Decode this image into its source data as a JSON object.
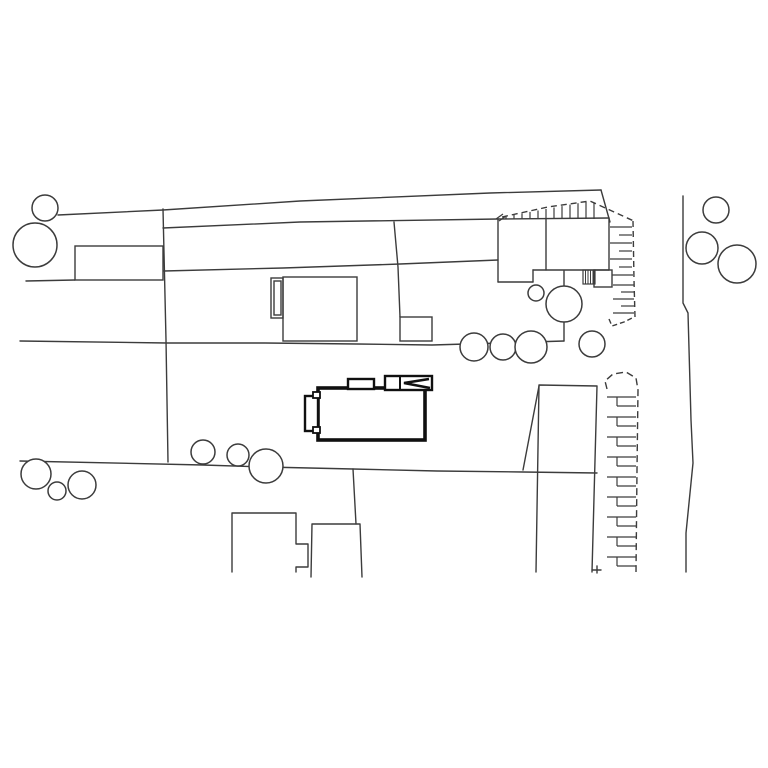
{
  "meta": {
    "canvas": {
      "w": 768,
      "h": 768
    },
    "colors": {
      "bg": "#ffffff",
      "line": "#3c3c3c",
      "bold": "#101010",
      "fill": "#ffffff"
    }
  },
  "plan": {
    "boundaries": {
      "width": 1.4,
      "polylines": [
        [
          [
            58,
            215
          ],
          [
            163,
            210
          ],
          [
            300,
            201
          ],
          [
            490,
            193
          ],
          [
            601,
            190
          ]
        ],
        [
          [
            601,
            190
          ],
          [
            610,
            222
          ]
        ],
        [
          [
            163,
            228
          ],
          [
            300,
            222
          ],
          [
            498,
            219
          ]
        ],
        [
          [
            26,
            281
          ],
          [
            75,
            280
          ]
        ],
        [
          [
            164,
            271
          ],
          [
            283,
            268
          ],
          [
            400,
            264
          ],
          [
            498,
            260
          ]
        ],
        [
          [
            20,
            341
          ],
          [
            167,
            343
          ],
          [
            265,
            343
          ],
          [
            357,
            344
          ],
          [
            432,
            345
          ],
          [
            500,
            343
          ],
          [
            564,
            341
          ]
        ],
        [
          [
            20,
            461
          ],
          [
            203,
            465
          ],
          [
            266,
            467
          ],
          [
            353,
            469
          ],
          [
            437,
            471
          ],
          [
            523,
            472
          ],
          [
            597,
            473
          ]
        ],
        [
          [
            163,
            209
          ],
          [
            166,
            340
          ],
          [
            168,
            462
          ]
        ],
        [
          [
            394,
            222
          ],
          [
            398,
            267
          ],
          [
            400,
            317
          ]
        ],
        [
          [
            353,
            469
          ],
          [
            356,
            524
          ]
        ],
        [
          [
            539,
            386
          ],
          [
            523,
            470
          ]
        ],
        [
          [
            564,
            271
          ],
          [
            564,
            341
          ]
        ],
        [
          [
            683,
            196
          ],
          [
            683,
            303
          ],
          [
            688,
            313
          ],
          [
            691,
            420
          ],
          [
            693,
            463
          ],
          [
            686,
            533
          ],
          [
            686,
            572
          ]
        ]
      ]
    },
    "buildings": {
      "width": 1.4,
      "rects": [
        [
          75,
          246,
          88,
          34
        ],
        [
          283,
          277,
          74,
          64
        ],
        [
          271,
          278,
          12,
          40
        ],
        [
          274,
          281,
          7,
          34
        ],
        [
          400,
          317,
          32,
          24
        ],
        [
          594,
          270,
          18,
          17
        ]
      ],
      "outlines": [
        [
          [
            232,
            572
          ],
          [
            232,
            513
          ],
          [
            296,
            513
          ],
          [
            296,
            544
          ],
          [
            308,
            544
          ],
          [
            308,
            567
          ],
          [
            296,
            567
          ],
          [
            296,
            572
          ]
        ],
        [
          [
            311,
            577
          ],
          [
            312,
            524
          ],
          [
            360,
            524
          ],
          [
            362,
            577
          ]
        ],
        [
          [
            536,
            572
          ],
          [
            539,
            385
          ],
          [
            597,
            386
          ],
          [
            592,
            572
          ]
        ],
        [
          [
            592,
            570
          ],
          [
            601,
            570
          ]
        ],
        [
          [
            597,
            566
          ],
          [
            597,
            573
          ]
        ],
        [
          [
            498,
            219
          ],
          [
            609,
            218
          ]
        ],
        [
          [
            498,
            219
          ],
          [
            498,
            282
          ]
        ],
        [
          [
            498,
            282
          ],
          [
            533,
            282
          ]
        ],
        [
          [
            533,
            282
          ],
          [
            533,
            270
          ]
        ],
        [
          [
            533,
            270
          ],
          [
            609,
            270
          ]
        ],
        [
          [
            609,
            218
          ],
          [
            609,
            270
          ]
        ],
        [
          [
            546,
            219
          ],
          [
            546,
            270
          ]
        ]
      ]
    },
    "dashed": {
      "width": 1.4,
      "polylines": [
        {
          "dash": "6 4",
          "pts": [
            [
              502,
              217
            ],
            [
              548,
              207
            ],
            [
              590,
              201
            ],
            [
              636,
              222
            ]
          ]
        },
        {
          "dash": "6 4",
          "pts": [
            [
              633,
              221
            ],
            [
              634,
              280
            ],
            [
              635,
              317
            ]
          ]
        },
        {
          "dash": "5 3",
          "pts": [
            [
              609,
              319
            ],
            [
              612,
              326
            ],
            [
              624,
              322
            ],
            [
              634,
              317
            ]
          ]
        },
        {
          "dash": "7 4",
          "pts": [
            [
              607,
              389
            ],
            [
              605,
              381
            ],
            [
              613,
              374
            ],
            [
              626,
              372
            ],
            [
              636,
              378
            ],
            [
              638,
              390
            ],
            [
              637,
              470
            ],
            [
              636,
              572
            ]
          ]
        }
      ]
    },
    "ticks": {
      "width": 1.2,
      "segments": [
        [
          506,
          216.3,
          506,
          219
        ],
        [
          514,
          214.9,
          514,
          219
        ],
        [
          522,
          213.4,
          522,
          219
        ],
        [
          530,
          211.9,
          530,
          219
        ],
        [
          538,
          210.5,
          538,
          219
        ],
        [
          546,
          209,
          546,
          219
        ],
        [
          554,
          207.5,
          554,
          219
        ],
        [
          562,
          206.1,
          562,
          219
        ],
        [
          570,
          204.6,
          570,
          219
        ],
        [
          578,
          203.2,
          578,
          219
        ],
        [
          586,
          201.7,
          586,
          219
        ],
        [
          594,
          202.8,
          594,
          219
        ],
        [
          496,
          219,
          503,
          214
        ],
        [
          499,
          221,
          506,
          216
        ],
        [
          610,
          227,
          632,
          227
        ],
        [
          619,
          235,
          632,
          235
        ],
        [
          610,
          243,
          632,
          243
        ],
        [
          619,
          251,
          632,
          251
        ],
        [
          610,
          259,
          632,
          259
        ],
        [
          619,
          267,
          632,
          267
        ],
        [
          612,
          275,
          633,
          275
        ],
        [
          613,
          285,
          634,
          285
        ],
        [
          621,
          292,
          634,
          292
        ],
        [
          613,
          299,
          634,
          299
        ],
        [
          621,
          306,
          634,
          306
        ],
        [
          613,
          313,
          634,
          313
        ],
        [
          607,
          397,
          636,
          397
        ],
        [
          607,
          417,
          636,
          417
        ],
        [
          607,
          437,
          636,
          437
        ],
        [
          607,
          457,
          636,
          457
        ],
        [
          607,
          477,
          636,
          477
        ],
        [
          607,
          497,
          636,
          497
        ],
        [
          607,
          517,
          636,
          517
        ],
        [
          607,
          537,
          636,
          537
        ],
        [
          607,
          557,
          636,
          557
        ],
        [
          617,
          406,
          636,
          406
        ],
        [
          617,
          426,
          636,
          426
        ],
        [
          617,
          446,
          636,
          446
        ],
        [
          617,
          466,
          636,
          466
        ],
        [
          617,
          486,
          636,
          486
        ],
        [
          617,
          506,
          636,
          506
        ],
        [
          617,
          526,
          636,
          526
        ],
        [
          617,
          546,
          636,
          546
        ],
        [
          617,
          566,
          636,
          566
        ],
        [
          617,
          397,
          617,
          406
        ],
        [
          617,
          417,
          617,
          426
        ],
        [
          617,
          437,
          617,
          446
        ],
        [
          617,
          457,
          617,
          466
        ],
        [
          617,
          477,
          617,
          486
        ],
        [
          617,
          497,
          617,
          506
        ],
        [
          617,
          517,
          617,
          526
        ],
        [
          617,
          537,
          617,
          546
        ],
        [
          617,
          557,
          617,
          566
        ]
      ]
    },
    "hatch": {
      "rect": [
        583,
        270,
        12,
        14
      ],
      "lines": [
        [
          585.5,
          270,
          585.5,
          284
        ],
        [
          588,
          270,
          588,
          284
        ],
        [
          590.5,
          270,
          590.5,
          284
        ],
        [
          593,
          270,
          593,
          284
        ]
      ]
    },
    "trees": {
      "width": 1.5,
      "circles": [
        [
          45,
          208,
          13
        ],
        [
          35,
          245,
          22
        ],
        [
          536,
          293,
          8
        ],
        [
          564,
          304,
          18
        ],
        [
          474,
          347,
          14
        ],
        [
          503,
          347,
          13
        ],
        [
          531,
          347,
          16
        ],
        [
          592,
          344,
          13
        ],
        [
          716,
          210,
          13
        ],
        [
          702,
          248,
          16
        ],
        [
          737,
          264,
          19
        ],
        [
          36,
          474,
          15
        ],
        [
          57,
          491,
          9
        ],
        [
          82,
          485,
          14
        ],
        [
          203,
          452,
          12
        ],
        [
          238,
          455,
          11
        ],
        [
          266,
          466,
          17
        ]
      ]
    },
    "subject": {
      "parts": [
        {
          "t": "rect",
          "x": 318,
          "y": 388,
          "w": 107,
          "h": 52,
          "sw": 3.6,
          "fill": "#ffffff",
          "name": "subject-building-main"
        },
        {
          "t": "rect",
          "x": 348,
          "y": 379,
          "w": 26,
          "h": 10,
          "sw": 2.4,
          "fill": "#ffffff",
          "name": "subject-roof-dormer"
        },
        {
          "t": "rect",
          "x": 385,
          "y": 376,
          "w": 47,
          "h": 14,
          "sw": 2.4,
          "fill": "#ffffff",
          "name": "subject-roof-structure"
        },
        {
          "t": "line",
          "x1": 400,
          "y1": 376,
          "x2": 400,
          "y2": 390,
          "sw": 2,
          "name": "subject-roof-divider"
        },
        {
          "t": "poly",
          "pts": [
            [
              429,
              379
            ],
            [
              404,
              383
            ],
            [
              430,
              388
            ]
          ],
          "sw": 2.6,
          "name": "subject-entrance-arrow"
        },
        {
          "t": "rect",
          "x": 305,
          "y": 396,
          "w": 13,
          "h": 35,
          "sw": 2.4,
          "fill": "#ffffff",
          "name": "subject-porch"
        },
        {
          "t": "rect",
          "x": 313,
          "y": 392,
          "w": 7,
          "h": 6,
          "sw": 1.8,
          "fill": "#ffffff",
          "name": "subject-porch-notch-top"
        },
        {
          "t": "rect",
          "x": 313,
          "y": 427,
          "w": 7,
          "h": 6,
          "sw": 1.8,
          "fill": "#ffffff",
          "name": "subject-porch-notch-bottom"
        }
      ]
    }
  }
}
